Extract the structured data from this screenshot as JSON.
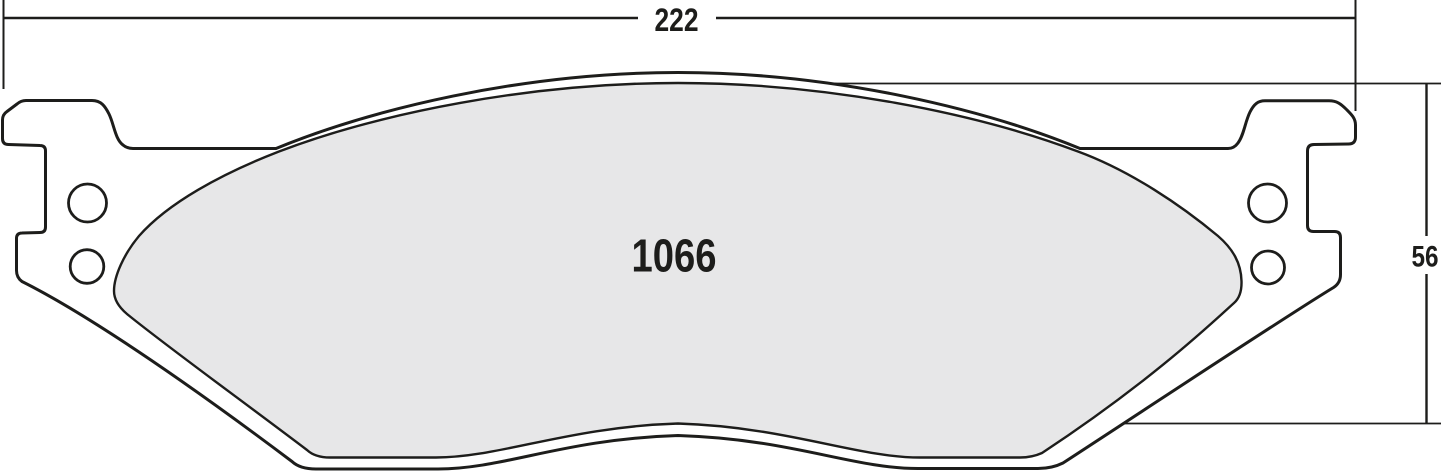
{
  "diagram": {
    "kind": "brake-pad-technical-drawing",
    "part_number": "1066",
    "dimensions": {
      "width_label": "222",
      "height_label": "56"
    },
    "colors": {
      "line": "#1d1d1b",
      "plate_fill": "#ffffff",
      "friction_fill": "#e7e7e8",
      "background": "#ffffff"
    }
  }
}
